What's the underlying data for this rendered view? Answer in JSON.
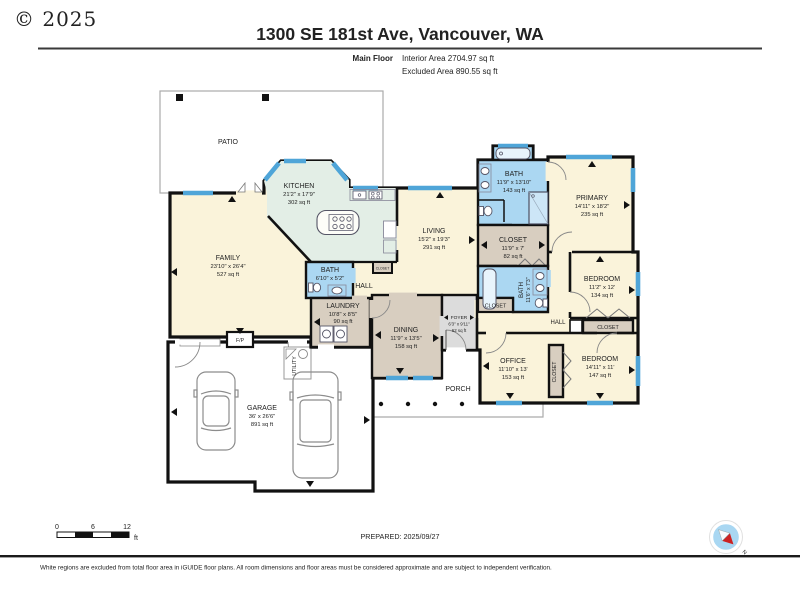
{
  "watermark": "© 2025",
  "header": {
    "title": "1300 SE 181st Ave, Vancouver, WA",
    "floor_label": "Main Floor",
    "interior_area": "Interior Area 2704.97 sq ft",
    "excluded_area": "Excluded Area 890.55 sq ft"
  },
  "rooms": {
    "patio": {
      "name": "PATIO"
    },
    "kitchen": {
      "name": "KITCHEN",
      "dims": "21'2\" x 17'9\"",
      "area": "302 sq ft"
    },
    "family": {
      "name": "FAMILY",
      "dims": "23'10\" x 26'4\"",
      "area": "527 sq ft"
    },
    "living": {
      "name": "LIVING",
      "dims": "15'2\" x 19'3\"",
      "area": "291 sq ft"
    },
    "bath_half": {
      "name": "BATH",
      "dims": "6'10\" x 5'2\""
    },
    "laundry": {
      "name": "LAUNDRY",
      "dims": "10'8\" x 8'5\"",
      "area": "90 sq ft"
    },
    "dining": {
      "name": "DINING",
      "dims": "11'9\" x 13'5\"",
      "area": "158 sq ft"
    },
    "foyer": {
      "name": "FOYER",
      "dims": "6'3\" x 9'11\"",
      "area": "62 sq ft"
    },
    "bath_primary": {
      "name": "BATH",
      "dims": "11'9\" x 13'10\"",
      "area": "143 sq ft"
    },
    "primary": {
      "name": "PRIMARY",
      "dims": "14'11\" x 18'2\"",
      "area": "235 sq ft"
    },
    "closet_primary": {
      "name": "CLOSET",
      "dims": "11'9\" x 7'",
      "area": "82 sq ft"
    },
    "bedroom1": {
      "name": "BEDROOM",
      "dims": "11'2\" x 12'",
      "area": "134 sq ft"
    },
    "bath_hall": {
      "name": "BATH",
      "dims": "11'6\" x 7'3\""
    },
    "office": {
      "name": "OFFICE",
      "dims": "11'10\" x 13'",
      "area": "153 sq ft"
    },
    "bedroom2": {
      "name": "BEDROOM",
      "dims": "14'11\" x 11'",
      "area": "147 sq ft"
    },
    "garage": {
      "name": "GARAGE",
      "dims": "36' x 26'6\"",
      "area": "891 sq ft"
    },
    "porch": {
      "name": "PORCH"
    },
    "utility": {
      "name": "UTILITY"
    },
    "hall_left": {
      "name": "HALL"
    },
    "hall_right": {
      "name": "HALL"
    },
    "closet_pantry": {
      "name": "CLOSET"
    },
    "closet_hallbath": {
      "name": "CLOSET"
    },
    "closet_bedroom1": {
      "name": "CLOSET"
    },
    "closet_bedroom2": {
      "name": "CLOSET"
    },
    "fireplace": {
      "name": "F/P"
    }
  },
  "footer": {
    "scale_ticks": [
      "0",
      "6",
      "12"
    ],
    "scale_unit": "ft",
    "prepared": "PREPARED: 2025/09/27",
    "compass_north": "N",
    "disclaimer": "White regions are excluded from total floor area in iGUIDE floor plans. All room dimensions and floor areas must be considered approximate and are subject to independent verification."
  },
  "colors": {
    "room_cream": "#FAF3DA",
    "kitchen_green": "#E3EEE6",
    "bath_blue": "#ABD7F2",
    "closet_tan": "#D8CEC0",
    "foyer_gray": "#DCDCDC",
    "window_blue": "#4FA5D8",
    "wall_black": "#111111"
  }
}
